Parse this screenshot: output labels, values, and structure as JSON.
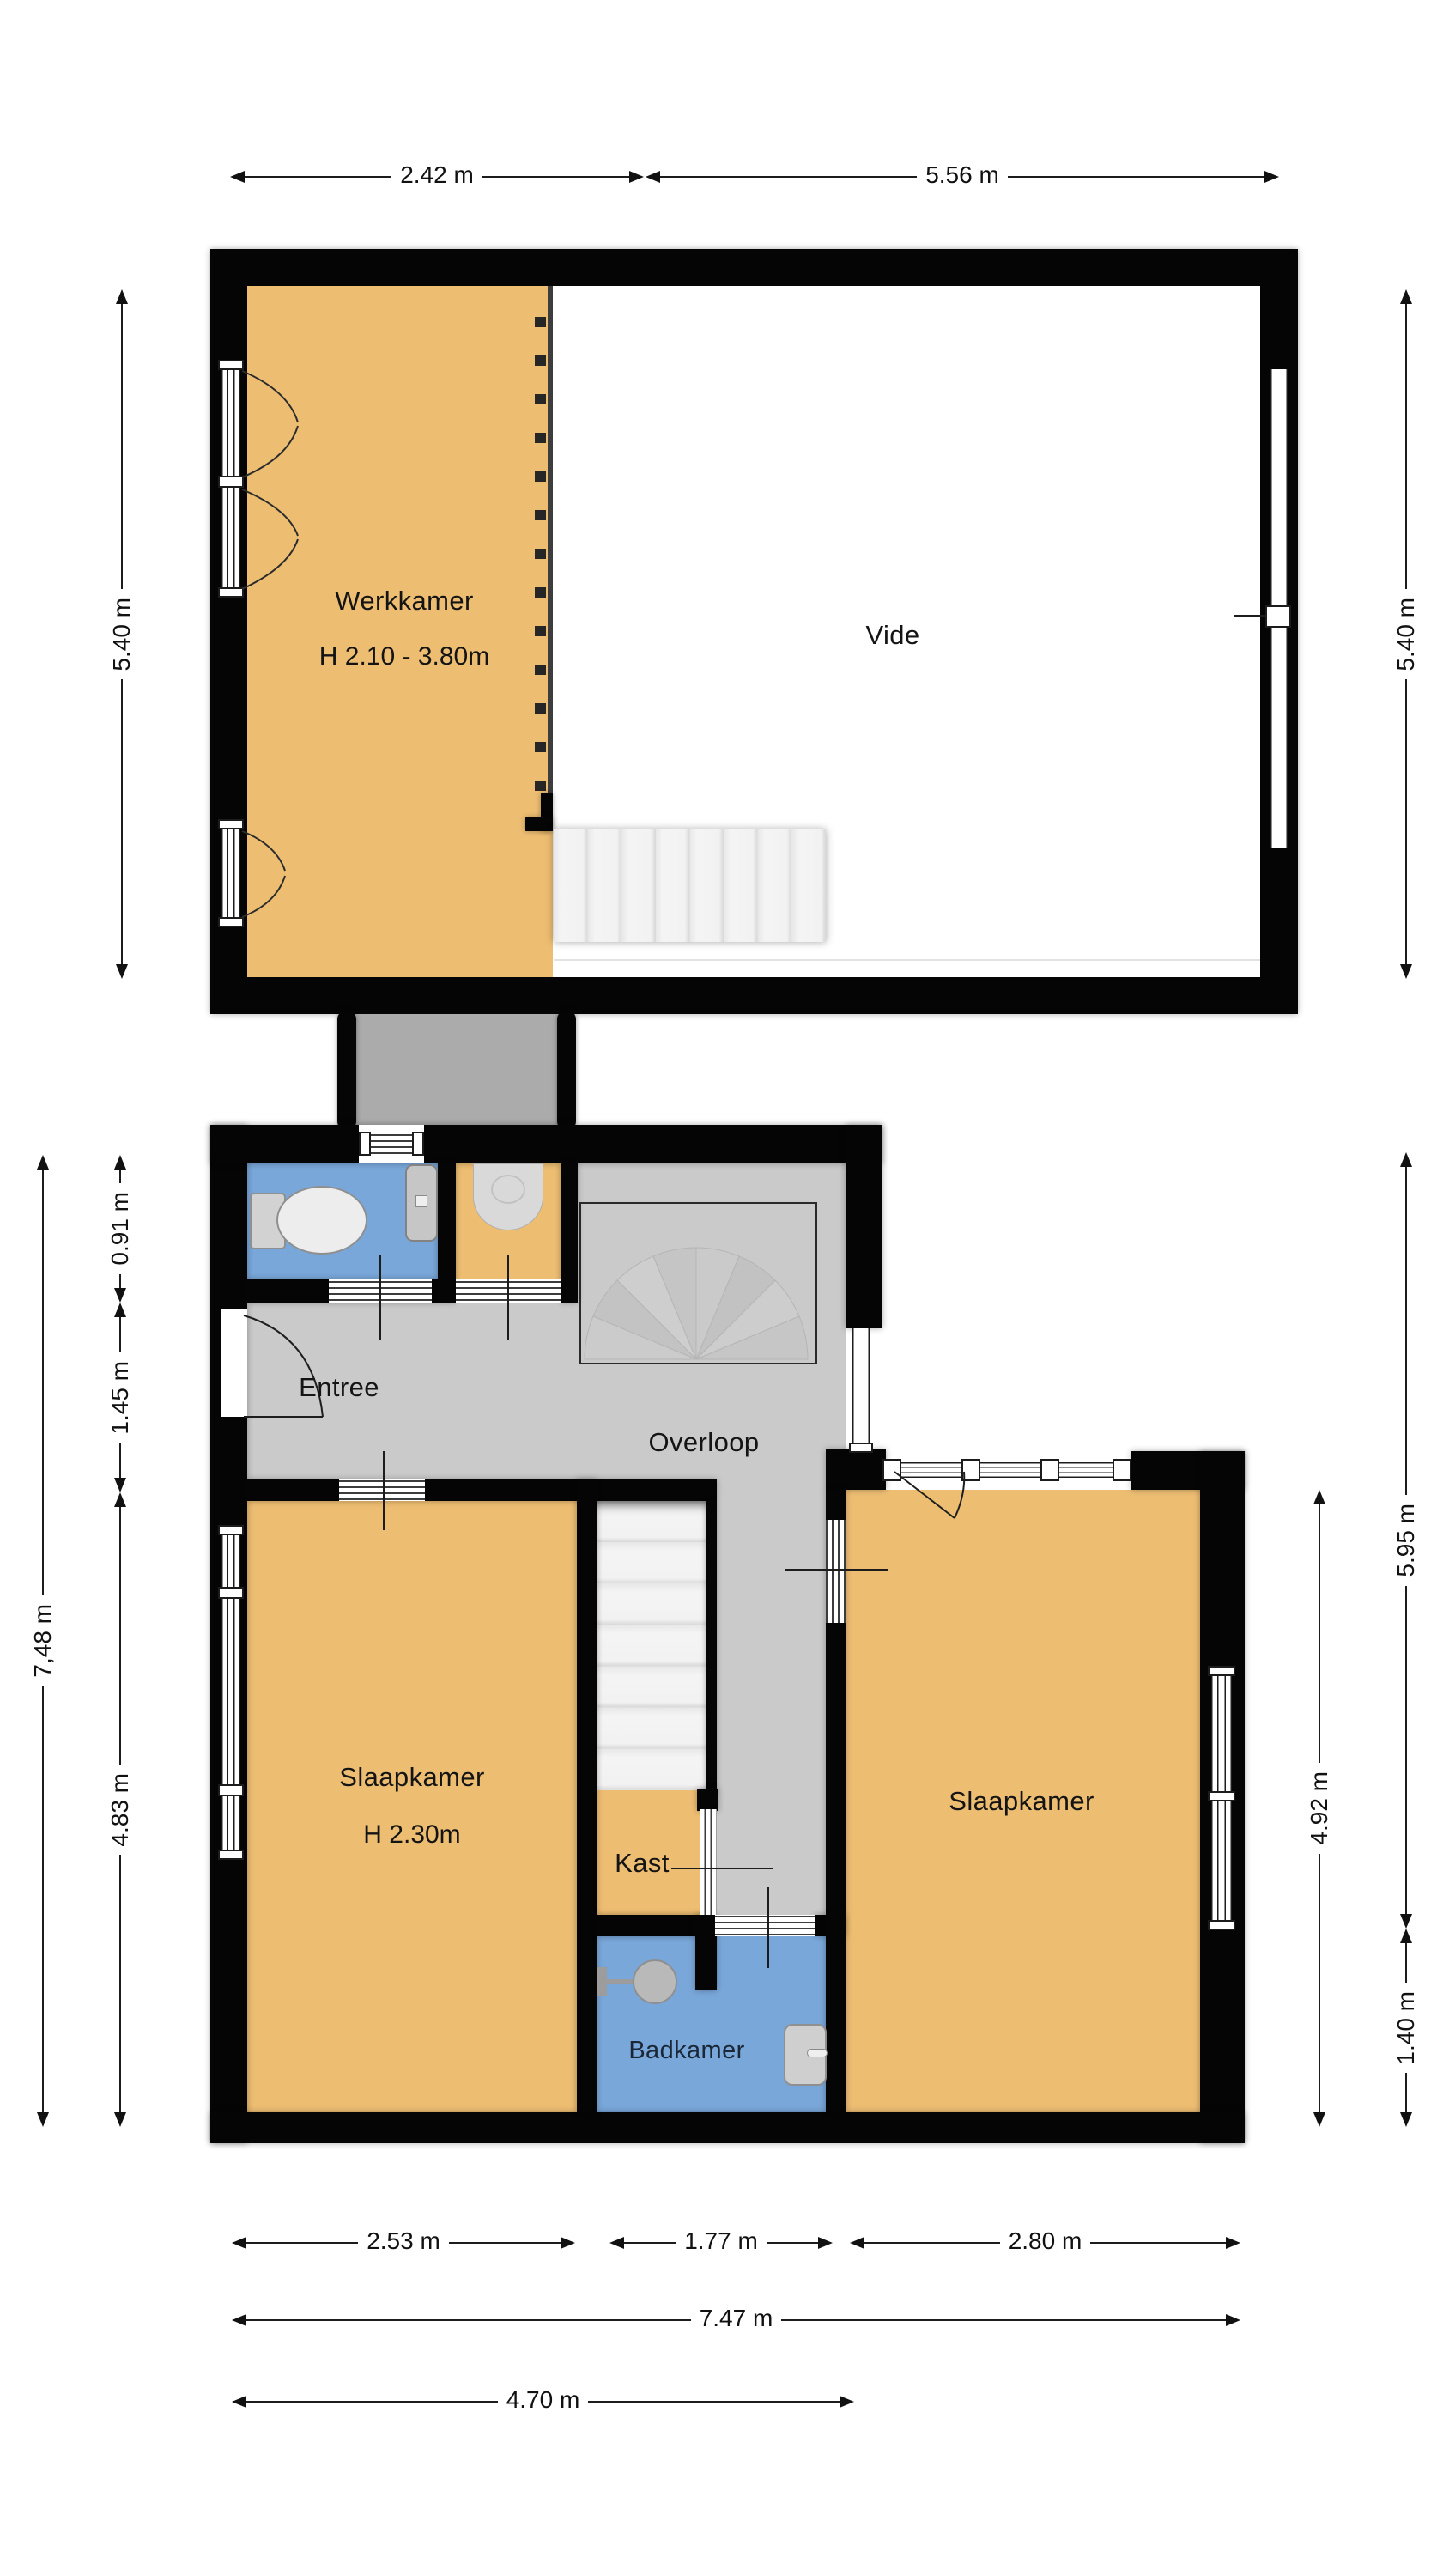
{
  "colors": {
    "wall": "#050505",
    "room": "#EDBD72",
    "wet": "#79A7D9",
    "hall": "#CACACA",
    "landing": "#ABABAB",
    "stairs": "#F1F1F1",
    "dimension": "#111111"
  },
  "upper_floor": {
    "rooms": {
      "werkkamer": "Werkkamer",
      "werkkamer_height": "H 2.10 - 3.80m",
      "vide": "Vide"
    },
    "dims": {
      "top_left": "2.42 m",
      "top_right": "5.56 m",
      "side_left": "5.40 m",
      "side_right": "5.40 m"
    }
  },
  "ground_floor": {
    "rooms": {
      "entree": "Entree",
      "overloop": "Overloop",
      "slaapkamer_left": "Slaapkamer",
      "slaapkamer_left_height": "H 2.30m",
      "kast": "Kast",
      "badkamer": "Badkamer",
      "slaapkamer_right": "Slaapkamer"
    },
    "dims": {
      "left_total": "7,48 m",
      "left_top": "0.91 m",
      "left_middle": "1.45 m",
      "left_bottom": "4.83 m",
      "right_top": "5.95 m",
      "right_inner": "4.92 m",
      "right_bottom": "1.40 m",
      "bottom_left": "2.53 m",
      "bottom_middle": "1.77 m",
      "bottom_right": "2.80 m",
      "bottom_total": "7.47 m",
      "bottom_partial": "4.70 m"
    }
  },
  "icons": {
    "toilet": "plan-symbol",
    "washbasin": "plan-symbol",
    "shower": "plan-symbol",
    "sink": "plan-symbol",
    "stairs_straight": "plan-symbol",
    "stairs_fan": "plan-symbol"
  }
}
